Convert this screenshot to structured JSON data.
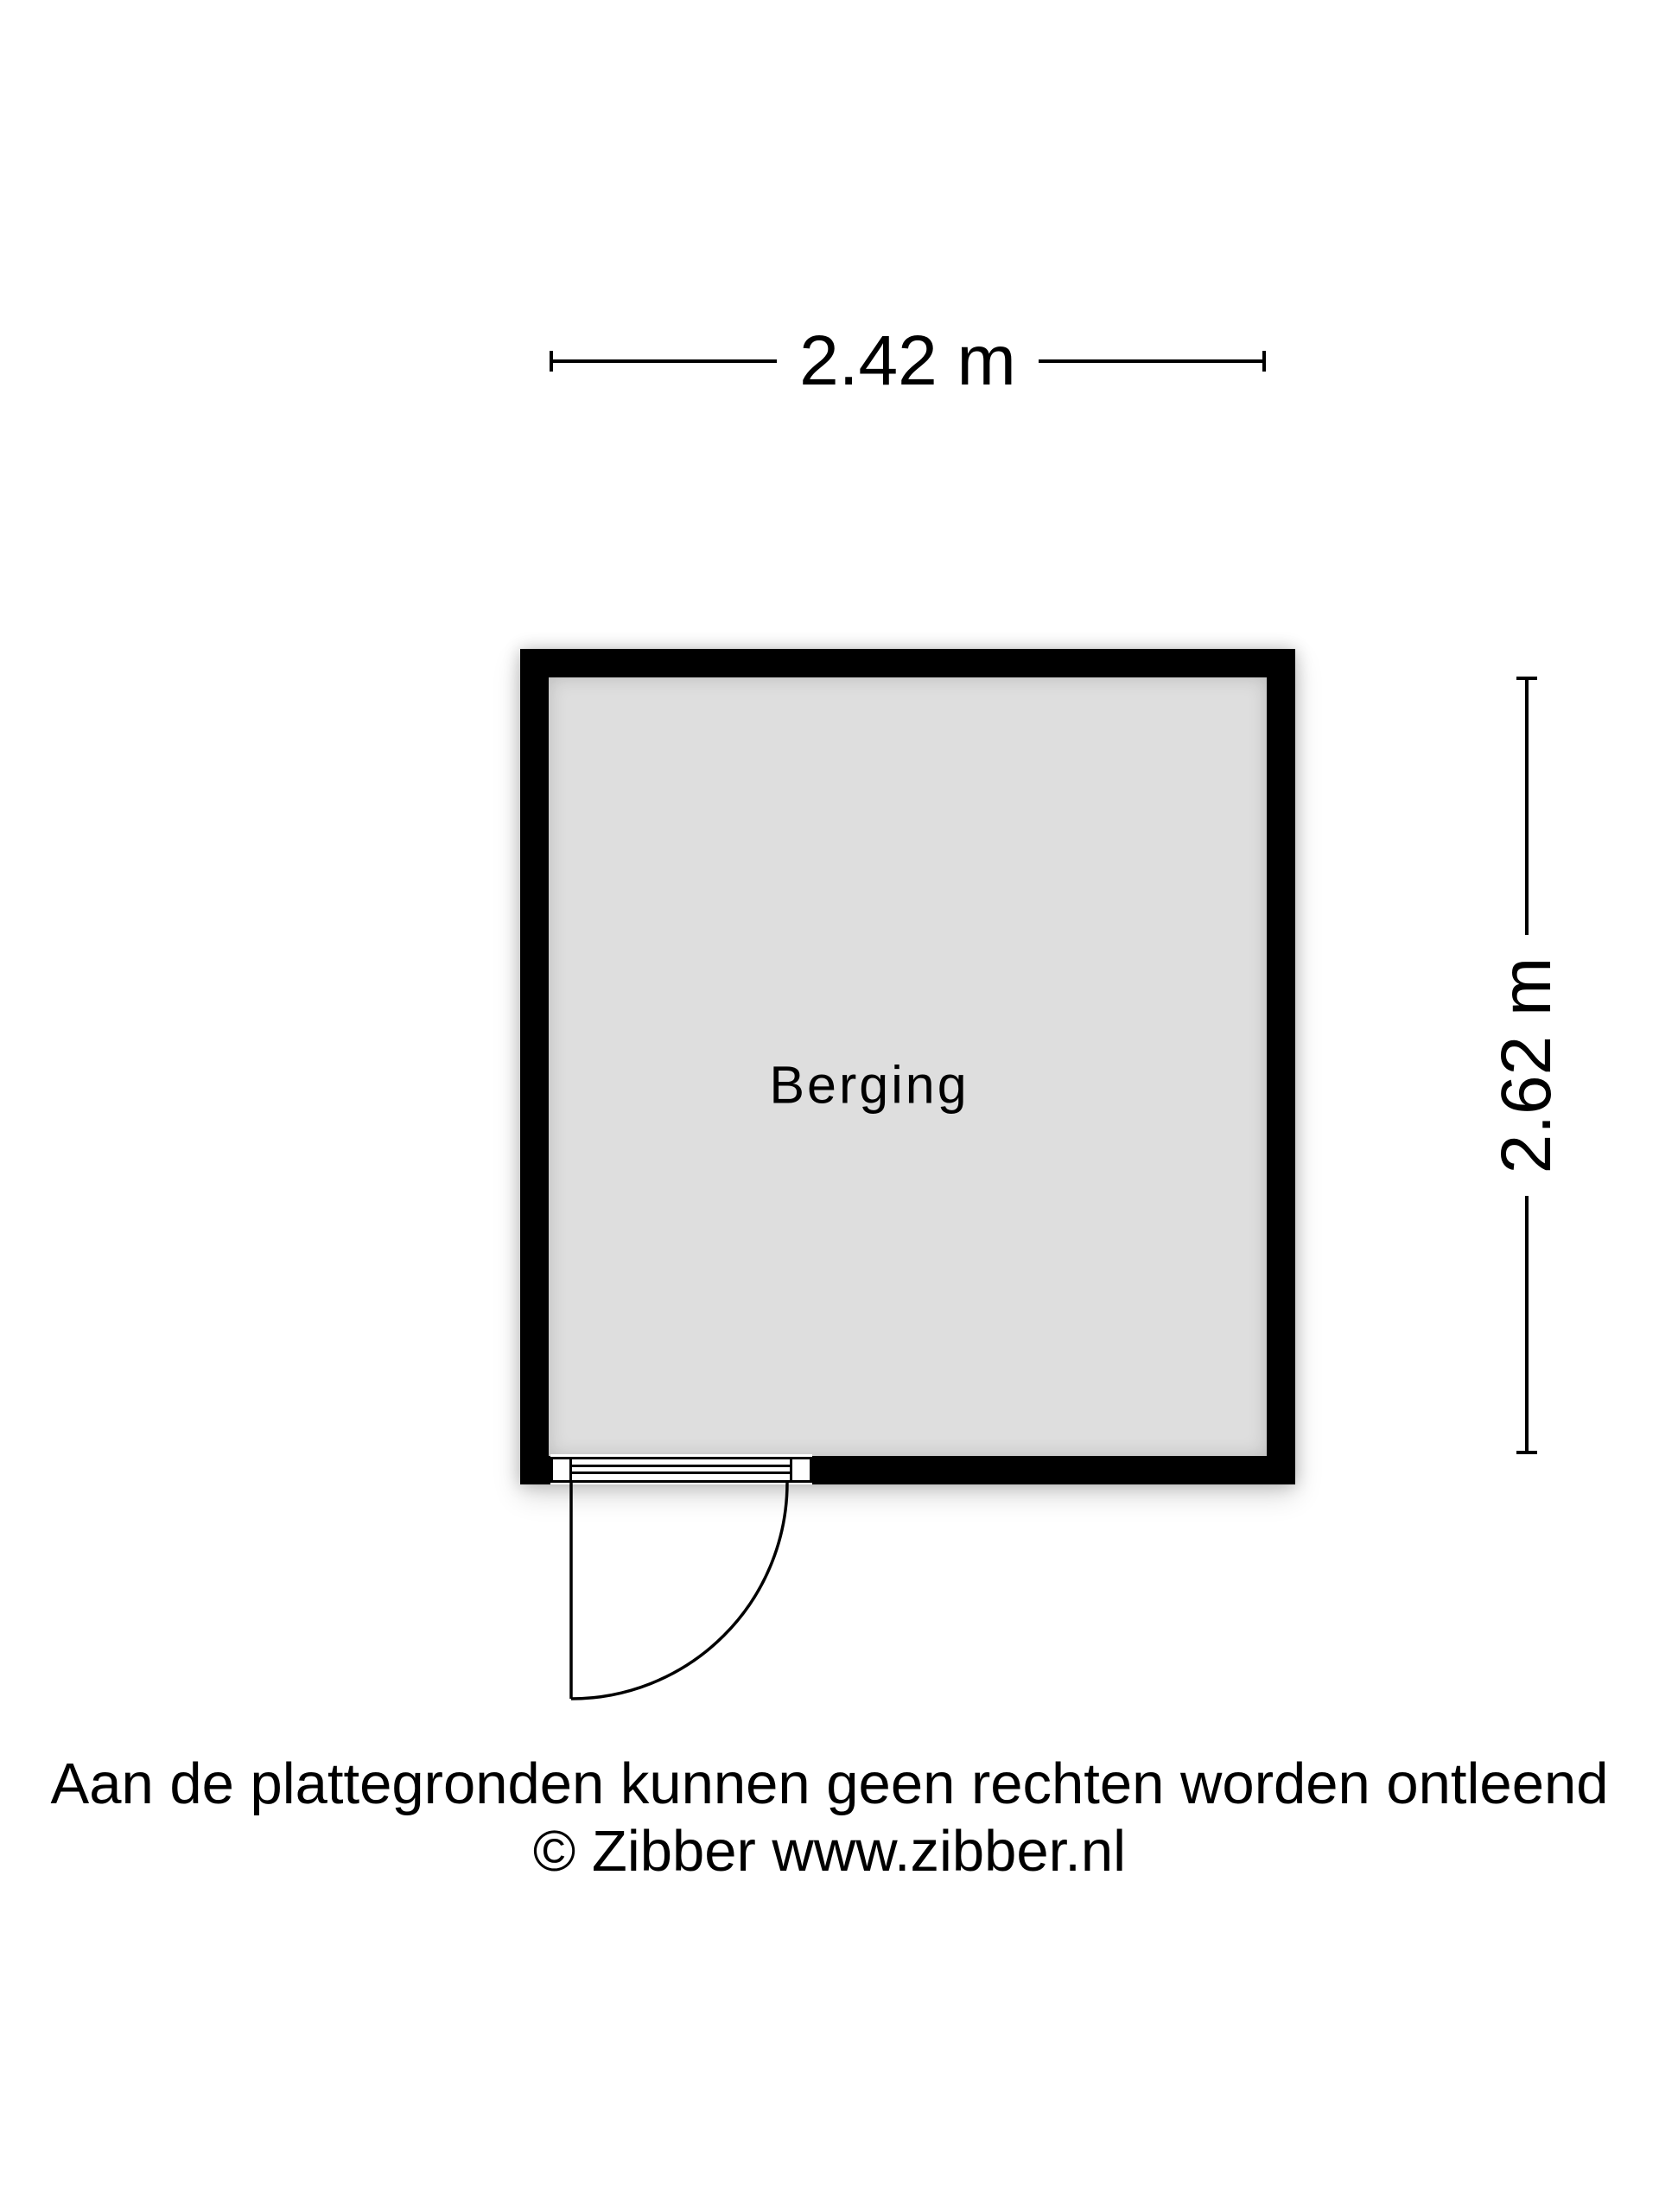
{
  "floorplan": {
    "room": {
      "name": "Berging"
    },
    "dimensions": {
      "width_label": "2.42 m",
      "height_label": "2.62 m"
    },
    "door": {
      "type": "single-swing",
      "position": "bottom-left"
    },
    "footer": {
      "disclaimer": "Aan de plattegronden kunnen geen rechten worden ontleend",
      "copyright": "© Zibber www.zibber.nl"
    },
    "colors": {
      "wall": "#000000",
      "floor": "#dedede",
      "line": "#000000",
      "text": "#000000",
      "background": "#ffffff"
    }
  }
}
